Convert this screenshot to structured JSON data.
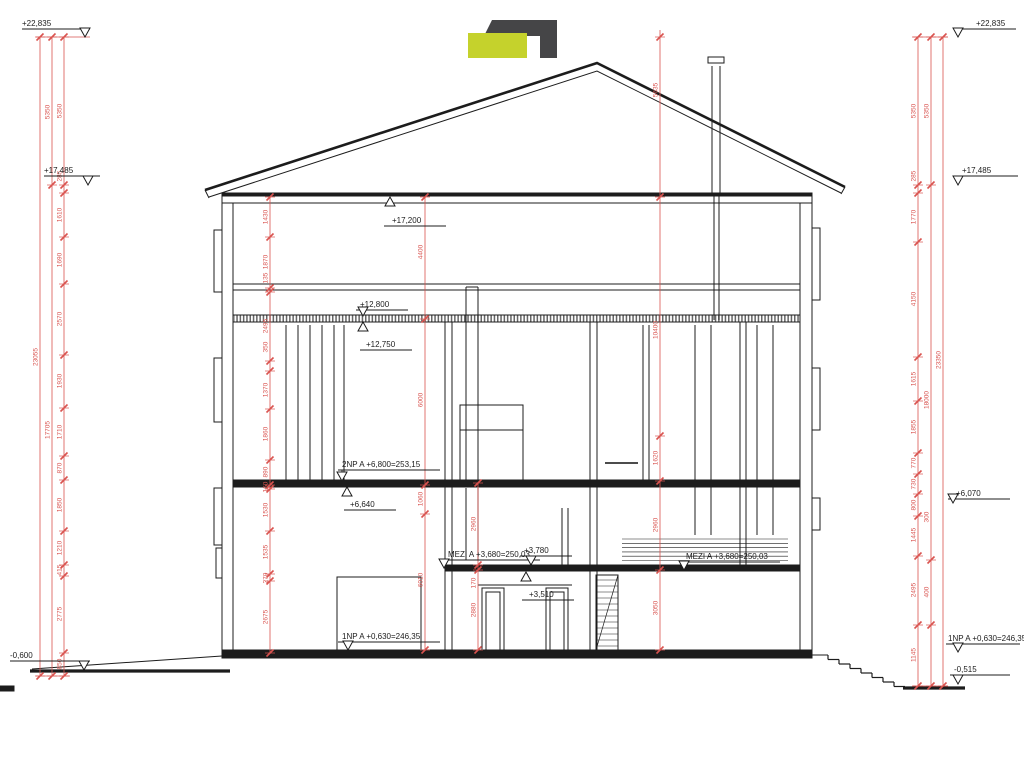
{
  "logo": {
    "name": "CONTENT",
    "tagline": "INDUSTRIAL REAL ESTATE",
    "mark": "logo-squares-icon"
  },
  "title": {
    "section": "ŘEZ A - A",
    "scale": "M 1 : 100"
  },
  "colors": {
    "dimension_red": "#d9534f",
    "line_black": "#1c1c1c",
    "hatch_gray": "#666666",
    "logo_yellow": "#c5d22c",
    "logo_gray": "#454547"
  },
  "area_label": "52,52",
  "elevations": {
    "left": [
      "+22,835",
      "+17,485",
      "-0,600"
    ],
    "right": [
      "+22,835",
      "+17,485",
      "+6,070",
      "1NP A +0,630=246,35",
      "-0,515"
    ],
    "interior": [
      "+17,200",
      "+12,800",
      "+12,750",
      "2NP A +6,800=253,15",
      "+6,640",
      "MEZI A +3,680=250,03",
      "+3,780",
      "+3,510",
      "MEZI A +3,680=250,03",
      "1NP A +0,630=246,35"
    ]
  },
  "dimension_chains": {
    "left_outer": [
      "23055"
    ],
    "left_middle": [
      "5350",
      "17705"
    ],
    "left_inner": [
      "5350",
      "285",
      "1610",
      "1690",
      "2570",
      "1930",
      "1710",
      "870",
      "1850",
      "1210",
      "415",
      "2775",
      "850"
    ],
    "interior_col_270": [
      "1430",
      "1870",
      "135",
      "2495",
      "350",
      "1370",
      "1860",
      "890",
      "160",
      "1530",
      "1535",
      "270",
      "2675"
    ],
    "interior_col_425": [
      "4400",
      "6000",
      "1060",
      "6010"
    ],
    "interior_col_478": [
      "2960",
      "170",
      "2880"
    ],
    "interior_col_660": [
      "5635",
      "10400",
      "1620",
      "2960",
      "3050"
    ],
    "right_inner": [
      "5350",
      "285",
      "1770",
      "4150",
      "1615",
      "1855",
      "770",
      "730",
      "800",
      "1445",
      "2495",
      "1145"
    ],
    "right_middle": [
      "5350",
      "18000",
      "300",
      "400"
    ],
    "right_outer": [
      "23350"
    ]
  }
}
